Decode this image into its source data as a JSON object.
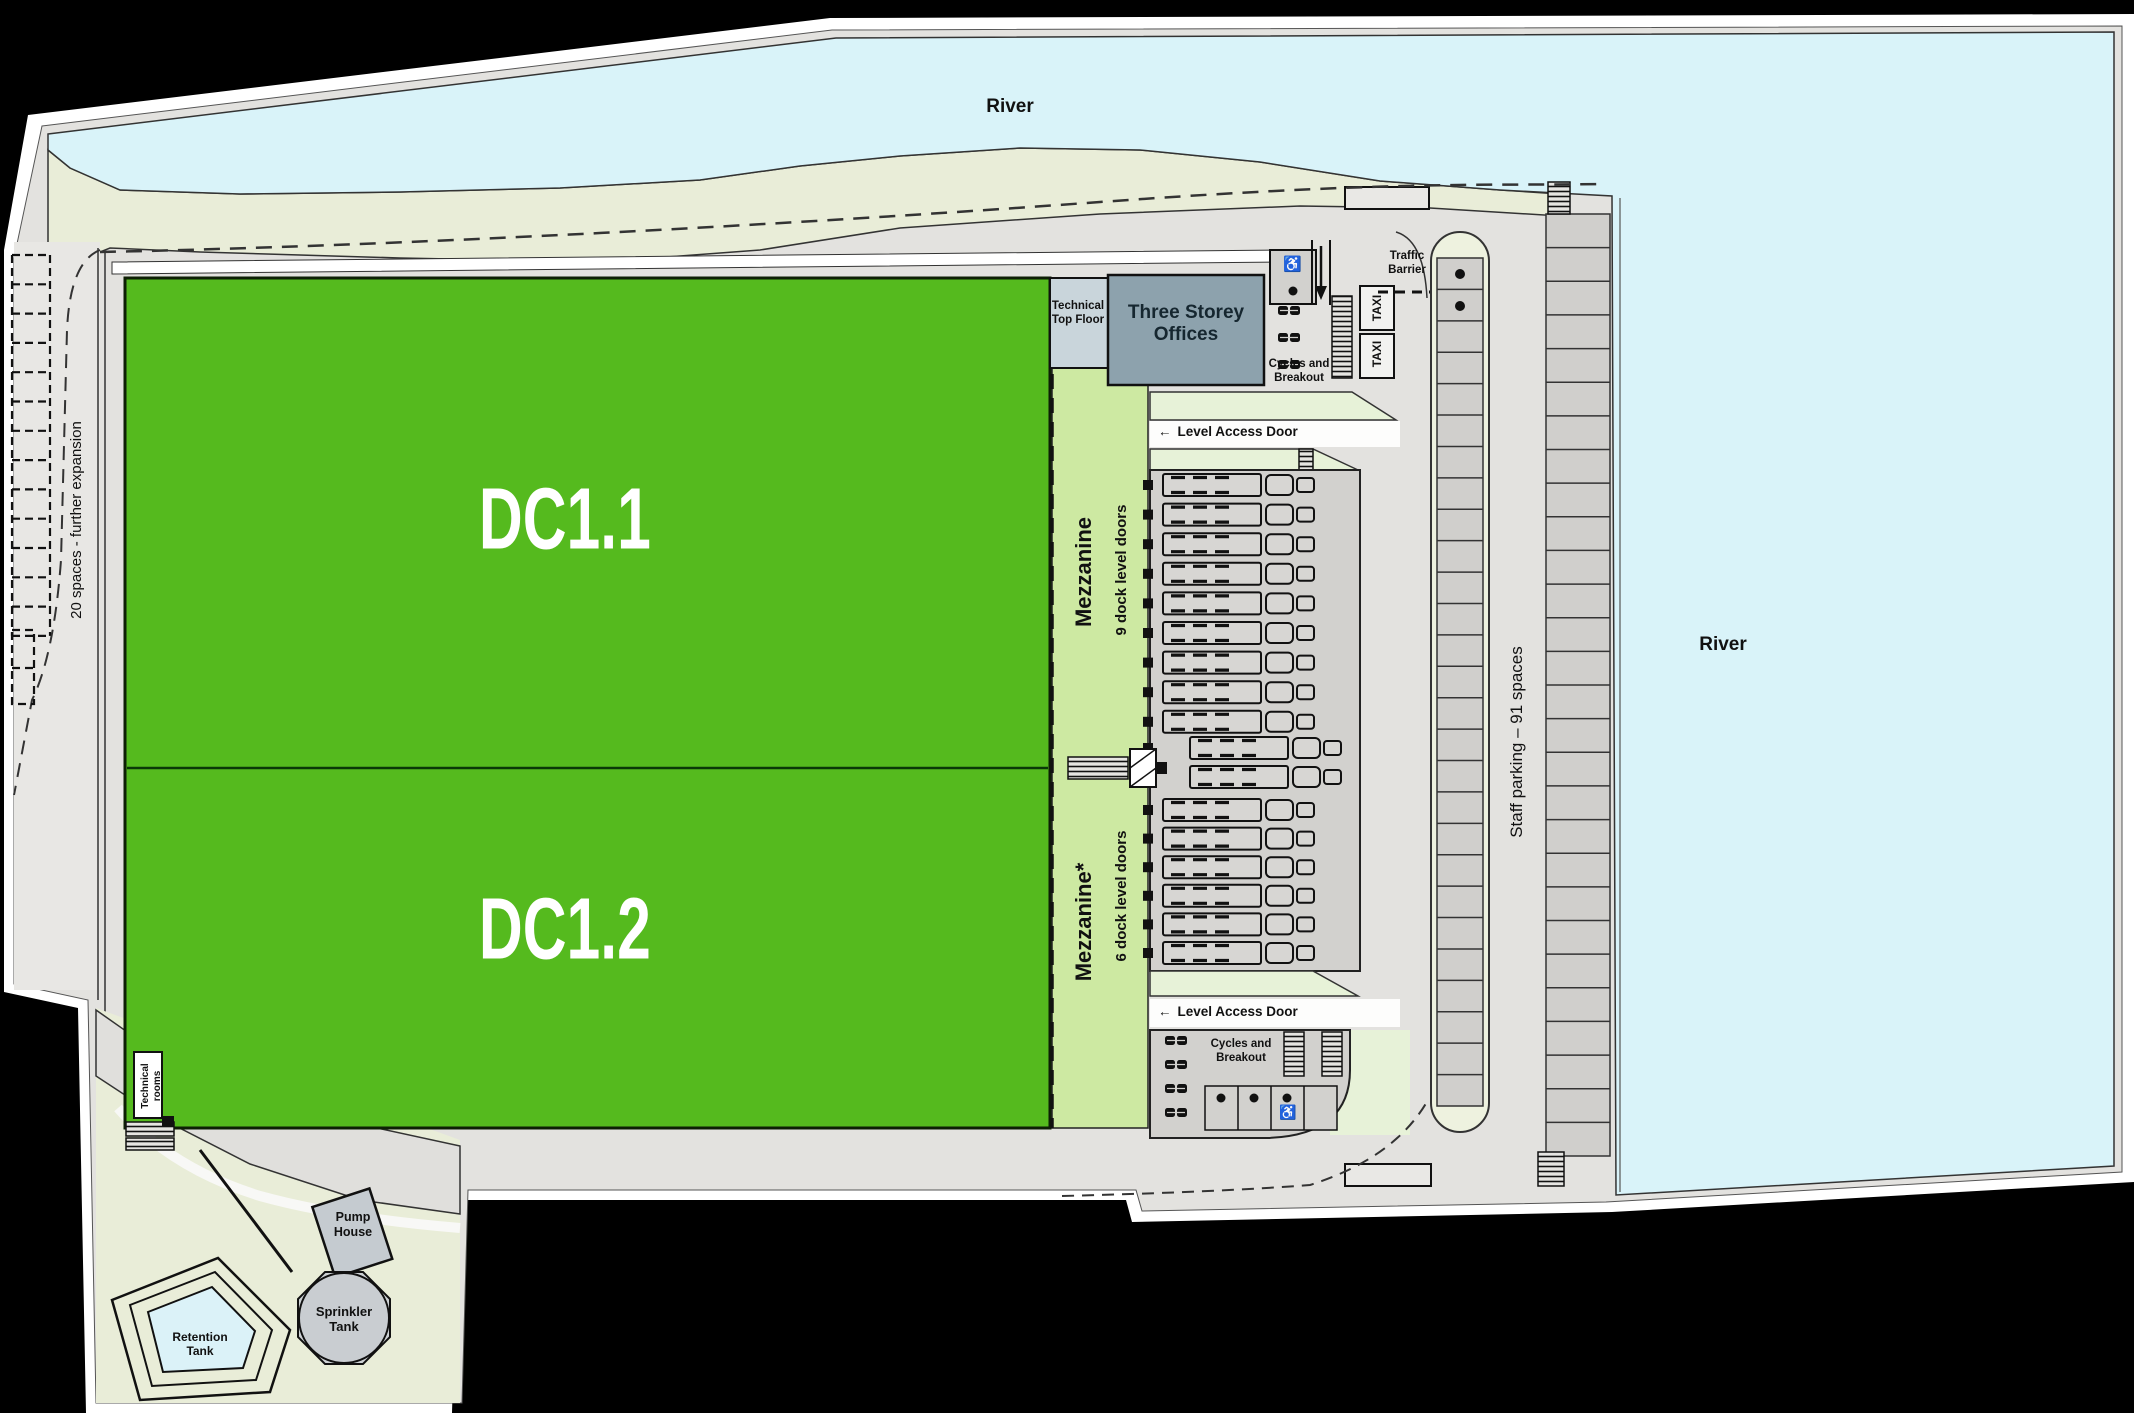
{
  "river": {
    "top_label": "River",
    "right_label": "River"
  },
  "buildings": {
    "dc11": "DC1.1",
    "dc12": "DC1.2",
    "mezzanine_top": {
      "name": "Mezzanine",
      "doors": "9 dock level doors"
    },
    "mezzanine_bottom": {
      "name": "Mezzanine*",
      "doors": "6 dock level doors"
    },
    "technical_top_floor": "Technical Top Floor",
    "offices": "Three Storey Offices",
    "technical_rooms": "Technical rooms",
    "pump_house": "Pump House",
    "sprinkler_tank": "Sprinkler Tank",
    "retention_tank": "Retention Tank"
  },
  "parking": {
    "staff": "Staff parking – 91 spaces",
    "expansion": "20 spaces - further expansion",
    "island_spaces": 27,
    "quay_spaces": 28,
    "expansion_rows": 13
  },
  "access": {
    "level_access_door": "Level Access Door",
    "traffic_barrier": "Traffic Barrier",
    "taxi": "TAXI",
    "cycles_top": "Cycles and Breakout",
    "cycles_bottom": "Cycles and Breakout"
  },
  "yard": {
    "trucks_top": 9,
    "trucks_middle": 2,
    "trucks_bottom": 6,
    "bikes_top": 3,
    "bikes_bottom": 4
  },
  "icons": {
    "left_arrow": "←",
    "down_arrow": "↓",
    "wheelchair": "♿",
    "dot": "●"
  },
  "colors": {
    "background": "#000000",
    "panel": "#ffffff",
    "river": "#d9f3f9",
    "shore": "#e9edd8",
    "road": "#e3e2df",
    "yard": "#d2d1ce",
    "building_green": "#55ba1e",
    "mezzanine_green": "#cde9a2",
    "pale_strip": "#e7f2d8",
    "offices_gray": "#8da2ad",
    "tech_floor": "#c9d5db",
    "tank_gray": "#c9cdd1",
    "water": "#dbf2f8"
  }
}
